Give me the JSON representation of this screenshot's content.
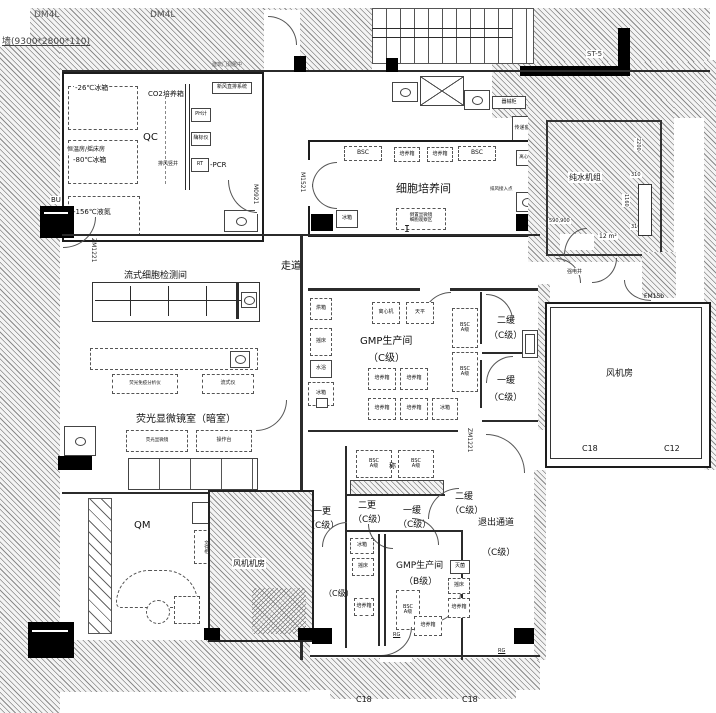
{
  "labels": {
    "dm4l": "DM4L",
    "wall_spec": "墙(9300*2800*110)",
    "door_note": "建筑门洞居中",
    "stair": "楼梯",
    "st5": "ST-5",
    "corridor": "走道",
    "qc": "QC",
    "qm": "QM",
    "cell_culture": "细胞培养间",
    "flow_room": "流式细胞检测间",
    "fluo_room": "荧光显微镜室（暗室）",
    "gmp_room": "GMP生产间",
    "grade_c": "（C级）",
    "grade_b": "（B级）",
    "pure_water": "纯水机组",
    "fan_room": "风机房",
    "fan_room2": "风机机房",
    "buffer1": "一缓",
    "buffer2": "二缓",
    "change1": "一更",
    "change2": "二更",
    "exit_corridor": "退出通道",
    "elec_shaft": "强电井",
    "area_12": "12 m²",
    "bu": "BU",
    "rg": "RG",
    "c18": "C18",
    "c12": "C12",
    "cursor": "I"
  },
  "equipment": {
    "bsc": "BSC",
    "grade_a": "A级",
    "incubator": "培养箱",
    "fridge": "冰箱",
    "fridge_26": "-26℃冰箱",
    "fridge_80": "-80℃冰箱",
    "ln2": "-156℃液氮",
    "co2_incubator": "CO2培养箱",
    "ph_meter": "PH计",
    "elisa": "酶标仪",
    "rt": "RT",
    "pcr": "-PCR",
    "shaker_room": "恒温房/摇床房",
    "exhaust_note": "新风直排系统",
    "vent_shaft": "排风竖井",
    "centrifuge": "离心机",
    "vent_point": "排风接入点",
    "micro_obs": "倒置显微镜",
    "obs_area": "细胞观察区",
    "pass_box": "传递窗",
    "cabinet": "器械柜",
    "immuno_analyzer": "荧光免疫分析仪",
    "flow_cytometer": "流式仪",
    "fluo_microscope": "荧光显微镜",
    "bench": "操作台",
    "file_cabinet": "文件柜",
    "weigh": "称",
    "oven": "烘箱",
    "shaker": "摇床",
    "water_bath": "水浴",
    "balance": "天平",
    "sterilizer": "灭菌"
  },
  "doors": {
    "m0921": "M0921",
    "m1521": "M1521",
    "zm1221": "ZM1221",
    "fm15b": "FM15b"
  },
  "dims": {
    "d2200": "2200",
    "d310": "310",
    "d1160": "1160",
    "d590": "590,900"
  }
}
